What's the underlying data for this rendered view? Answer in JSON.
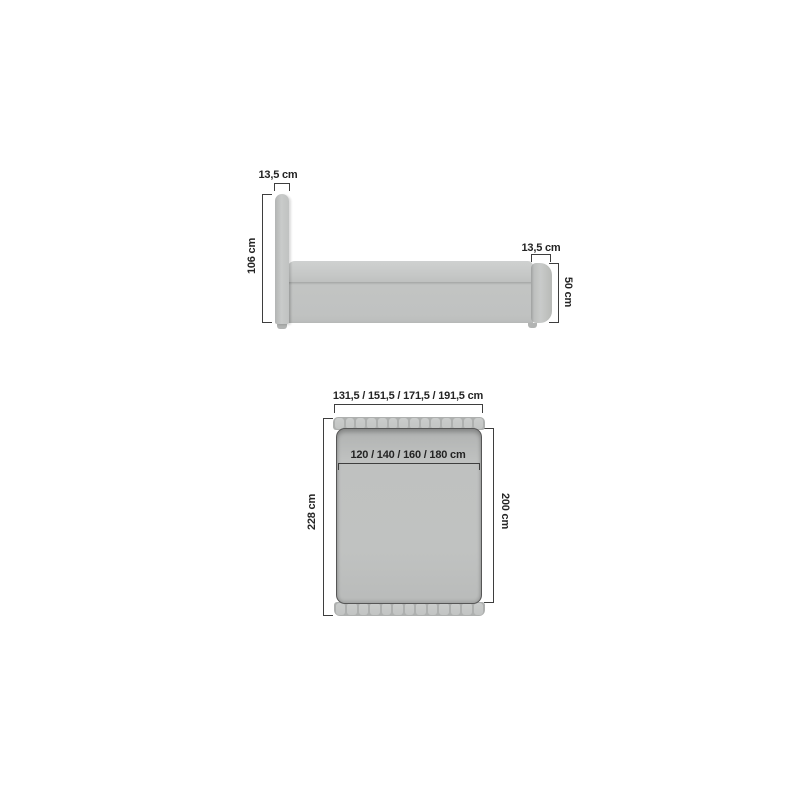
{
  "side_view": {
    "headboard_thickness_label": "13,5 cm",
    "overall_height_label": "106 cm",
    "footboard_thickness_label": "13,5 cm",
    "footboard_height_label": "50 cm",
    "frame_height_label": "33,5 cm"
  },
  "top_view": {
    "overall_width_options_label": "131,5 / 151,5 / 171,5 / 191,5 cm",
    "mattress_width_options_label": "120 / 140 / 160 / 180 cm",
    "overall_length_label": "228 cm",
    "mattress_length_label": "200 cm"
  },
  "units": "cm",
  "colors": {
    "background": "#ffffff",
    "upholstery": "#c3c5c4",
    "upholstery_light": "#cccecd",
    "upholstery_shadow": "#a8aaa9",
    "outline": "#565656",
    "dimension_line": "#3e3e3e",
    "text": "#242424"
  }
}
